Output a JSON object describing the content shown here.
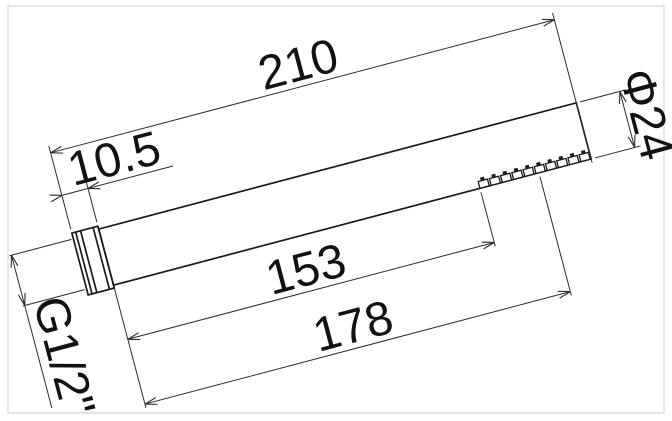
{
  "drawing": {
    "dims": {
      "overall_length": "210",
      "connector_length": "10.5",
      "diameter": "Φ24",
      "nozzle_start_length": "153",
      "nozzle_end_length": "178",
      "thread": "G1/2\""
    },
    "nozzles": {
      "count": 10
    },
    "colors": {
      "outline": "#1a1a1a",
      "dimension": "#2b2b2b",
      "frame": "#cdcdcd",
      "background": "#ffffff"
    }
  }
}
